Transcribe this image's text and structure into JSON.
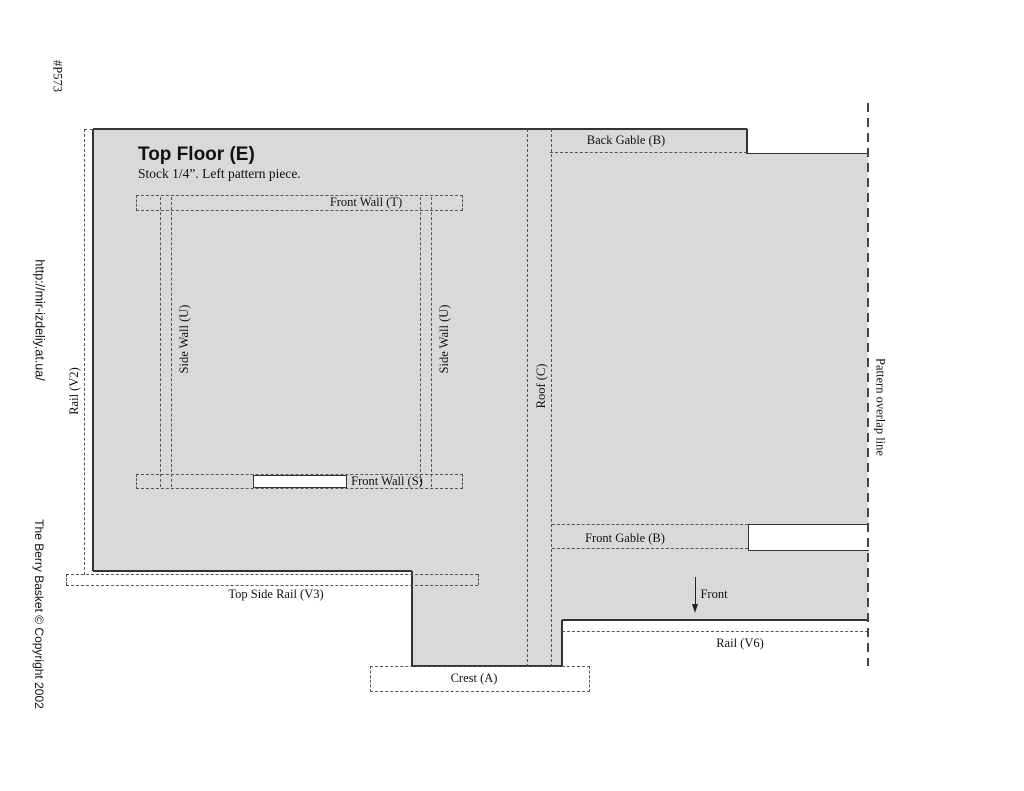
{
  "page": {
    "code": "#P573",
    "url": "http://mir-izdeliy.at.ua/",
    "copyright": "The Berry Basket © Copyright 2002"
  },
  "title_block": {
    "title": "Top Floor (E)",
    "subtitle": "Stock 1/4”. Left pattern piece."
  },
  "labels": {
    "front_wall_t": "Front Wall (T)",
    "front_wall_s": "Front Wall (S)",
    "side_wall_left": "Side Wall (U)",
    "side_wall_right": "Side Wall (U)",
    "roof": "Roof (C)",
    "back_gable": "Back Gable (B)",
    "front_gable": "Front Gable (B)",
    "rail_v2": "Rail (V2)",
    "top_side_rail_v3": "Top Side Rail (V3)",
    "rail_v6": "Rail (V6)",
    "crest": "Crest (A)",
    "front": "Front",
    "pattern_overlap": "Pattern overlap line"
  },
  "colors": {
    "piece_fill": "#d9d9d9",
    "outline": "#333333",
    "dashed_line": "#555555",
    "background": "#ffffff"
  }
}
